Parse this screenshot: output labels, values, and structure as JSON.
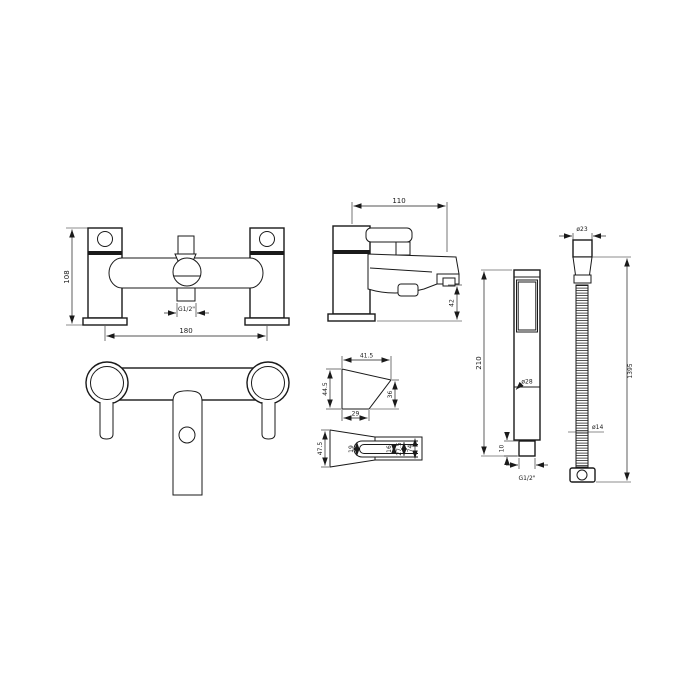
{
  "drawing": {
    "front_view": {
      "height_dim": "108",
      "centres_dim": "180",
      "outlet_thread": "G1/2\""
    },
    "side_view": {
      "projection_dim": "110",
      "spout_height_dim": "42"
    },
    "bracket_side_view": {
      "top_dim": "41.5",
      "left_dim": "44.5",
      "right_dim": "36",
      "bottom_dim": "29"
    },
    "bracket_front_view": {
      "left_dim": "47.5",
      "clip_dim": "19",
      "inner_dim": "16",
      "mid_dim": "27.5",
      "right_dim": "74"
    },
    "handset": {
      "length_dim": "210",
      "diameter_dim": "ø28",
      "connector_dim": "10",
      "thread": "G1/2\""
    },
    "hose": {
      "top_diameter_dim": "ø23",
      "length_dim": "1395",
      "mid_diameter_dim": "ø14"
    }
  }
}
